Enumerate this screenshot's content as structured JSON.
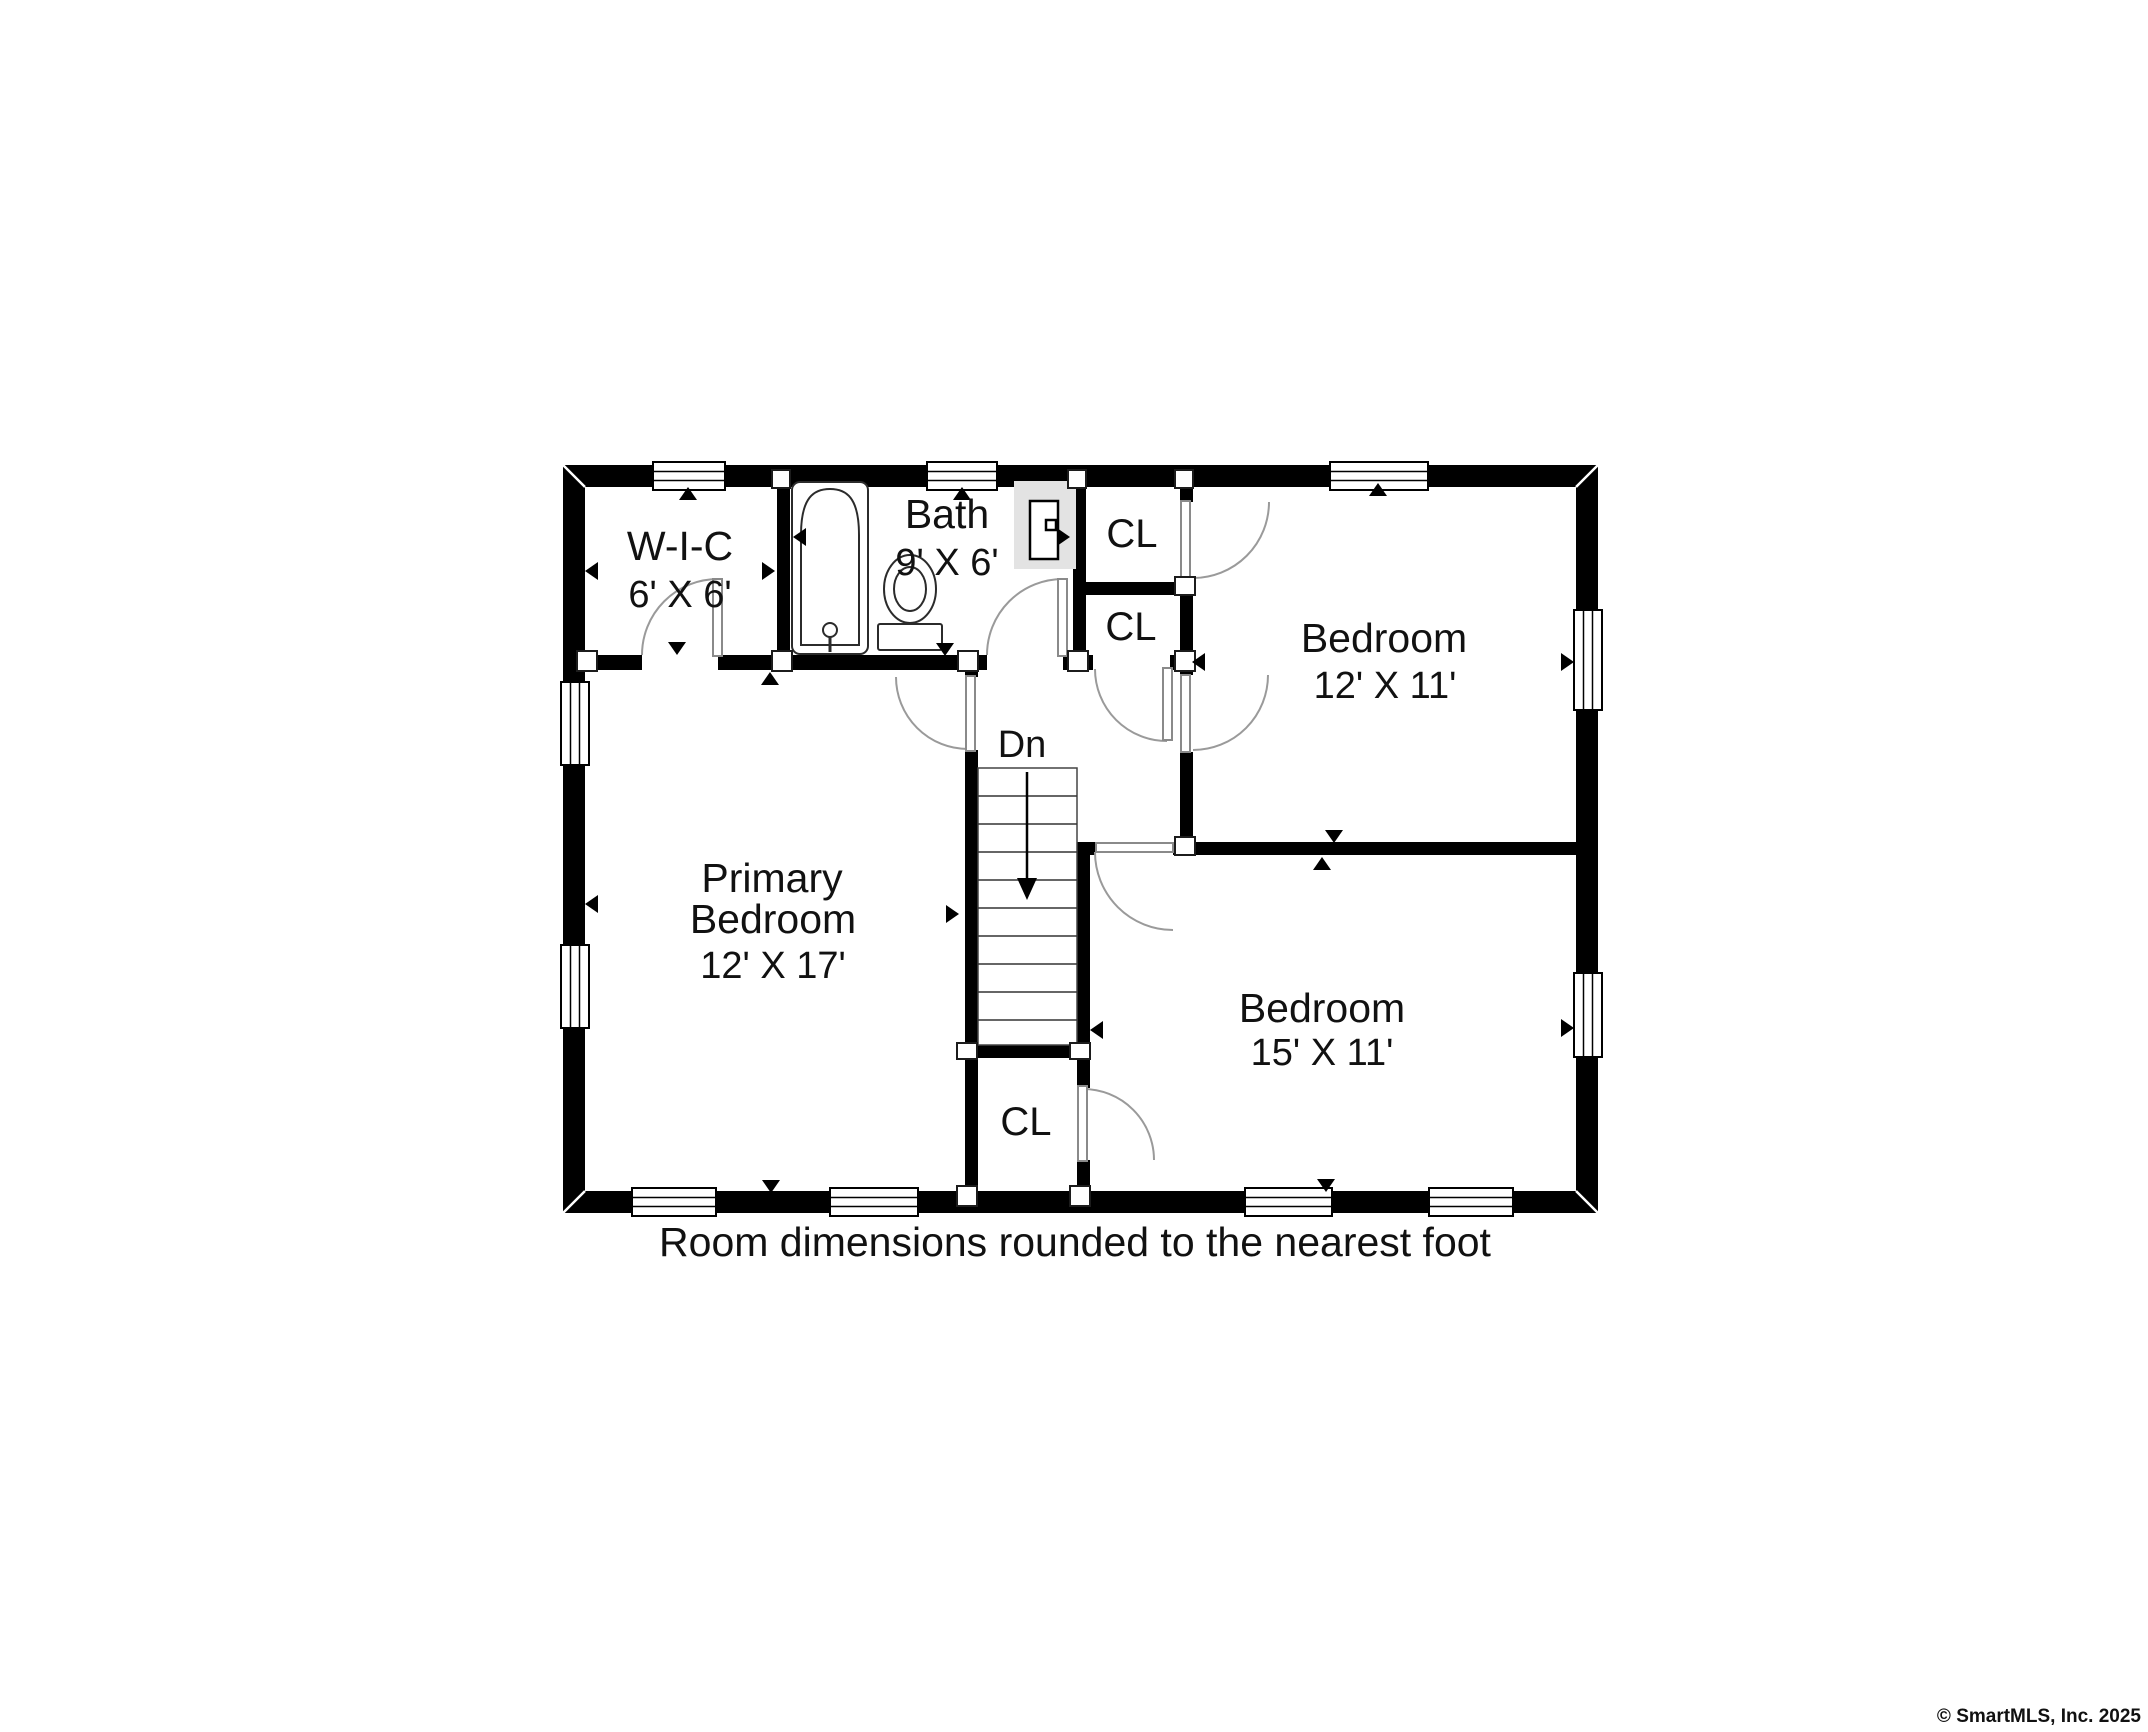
{
  "plan": {
    "rooms": {
      "wic": {
        "name": "W-I-C",
        "dims": "6' X 6'"
      },
      "bath": {
        "name": "Bath",
        "dims": "9' X 6'"
      },
      "closet_top": {
        "name": "CL"
      },
      "closet_mid": {
        "name": "CL"
      },
      "closet_under_stairs": {
        "name": "CL"
      },
      "bedroom_right": {
        "name": "Bedroom",
        "dims": "12' X 11'"
      },
      "bedroom_bottom": {
        "name": "Bedroom",
        "dims": "15' X 11'"
      },
      "primary_bedroom": {
        "name_line1": "Primary",
        "name_line2": "Bedroom",
        "dims": "12' X 17'"
      }
    },
    "stairs": {
      "label": "Dn"
    }
  },
  "caption": "Room dimensions rounded to the nearest foot",
  "copyright": "© SmartMLS, Inc. 2025",
  "colors": {
    "wall": "#000000",
    "background": "#ffffff",
    "door_arc": "#9a9a9a",
    "vanity_fill": "#e3e3e3",
    "copyright_text": "#b9b9b9"
  }
}
